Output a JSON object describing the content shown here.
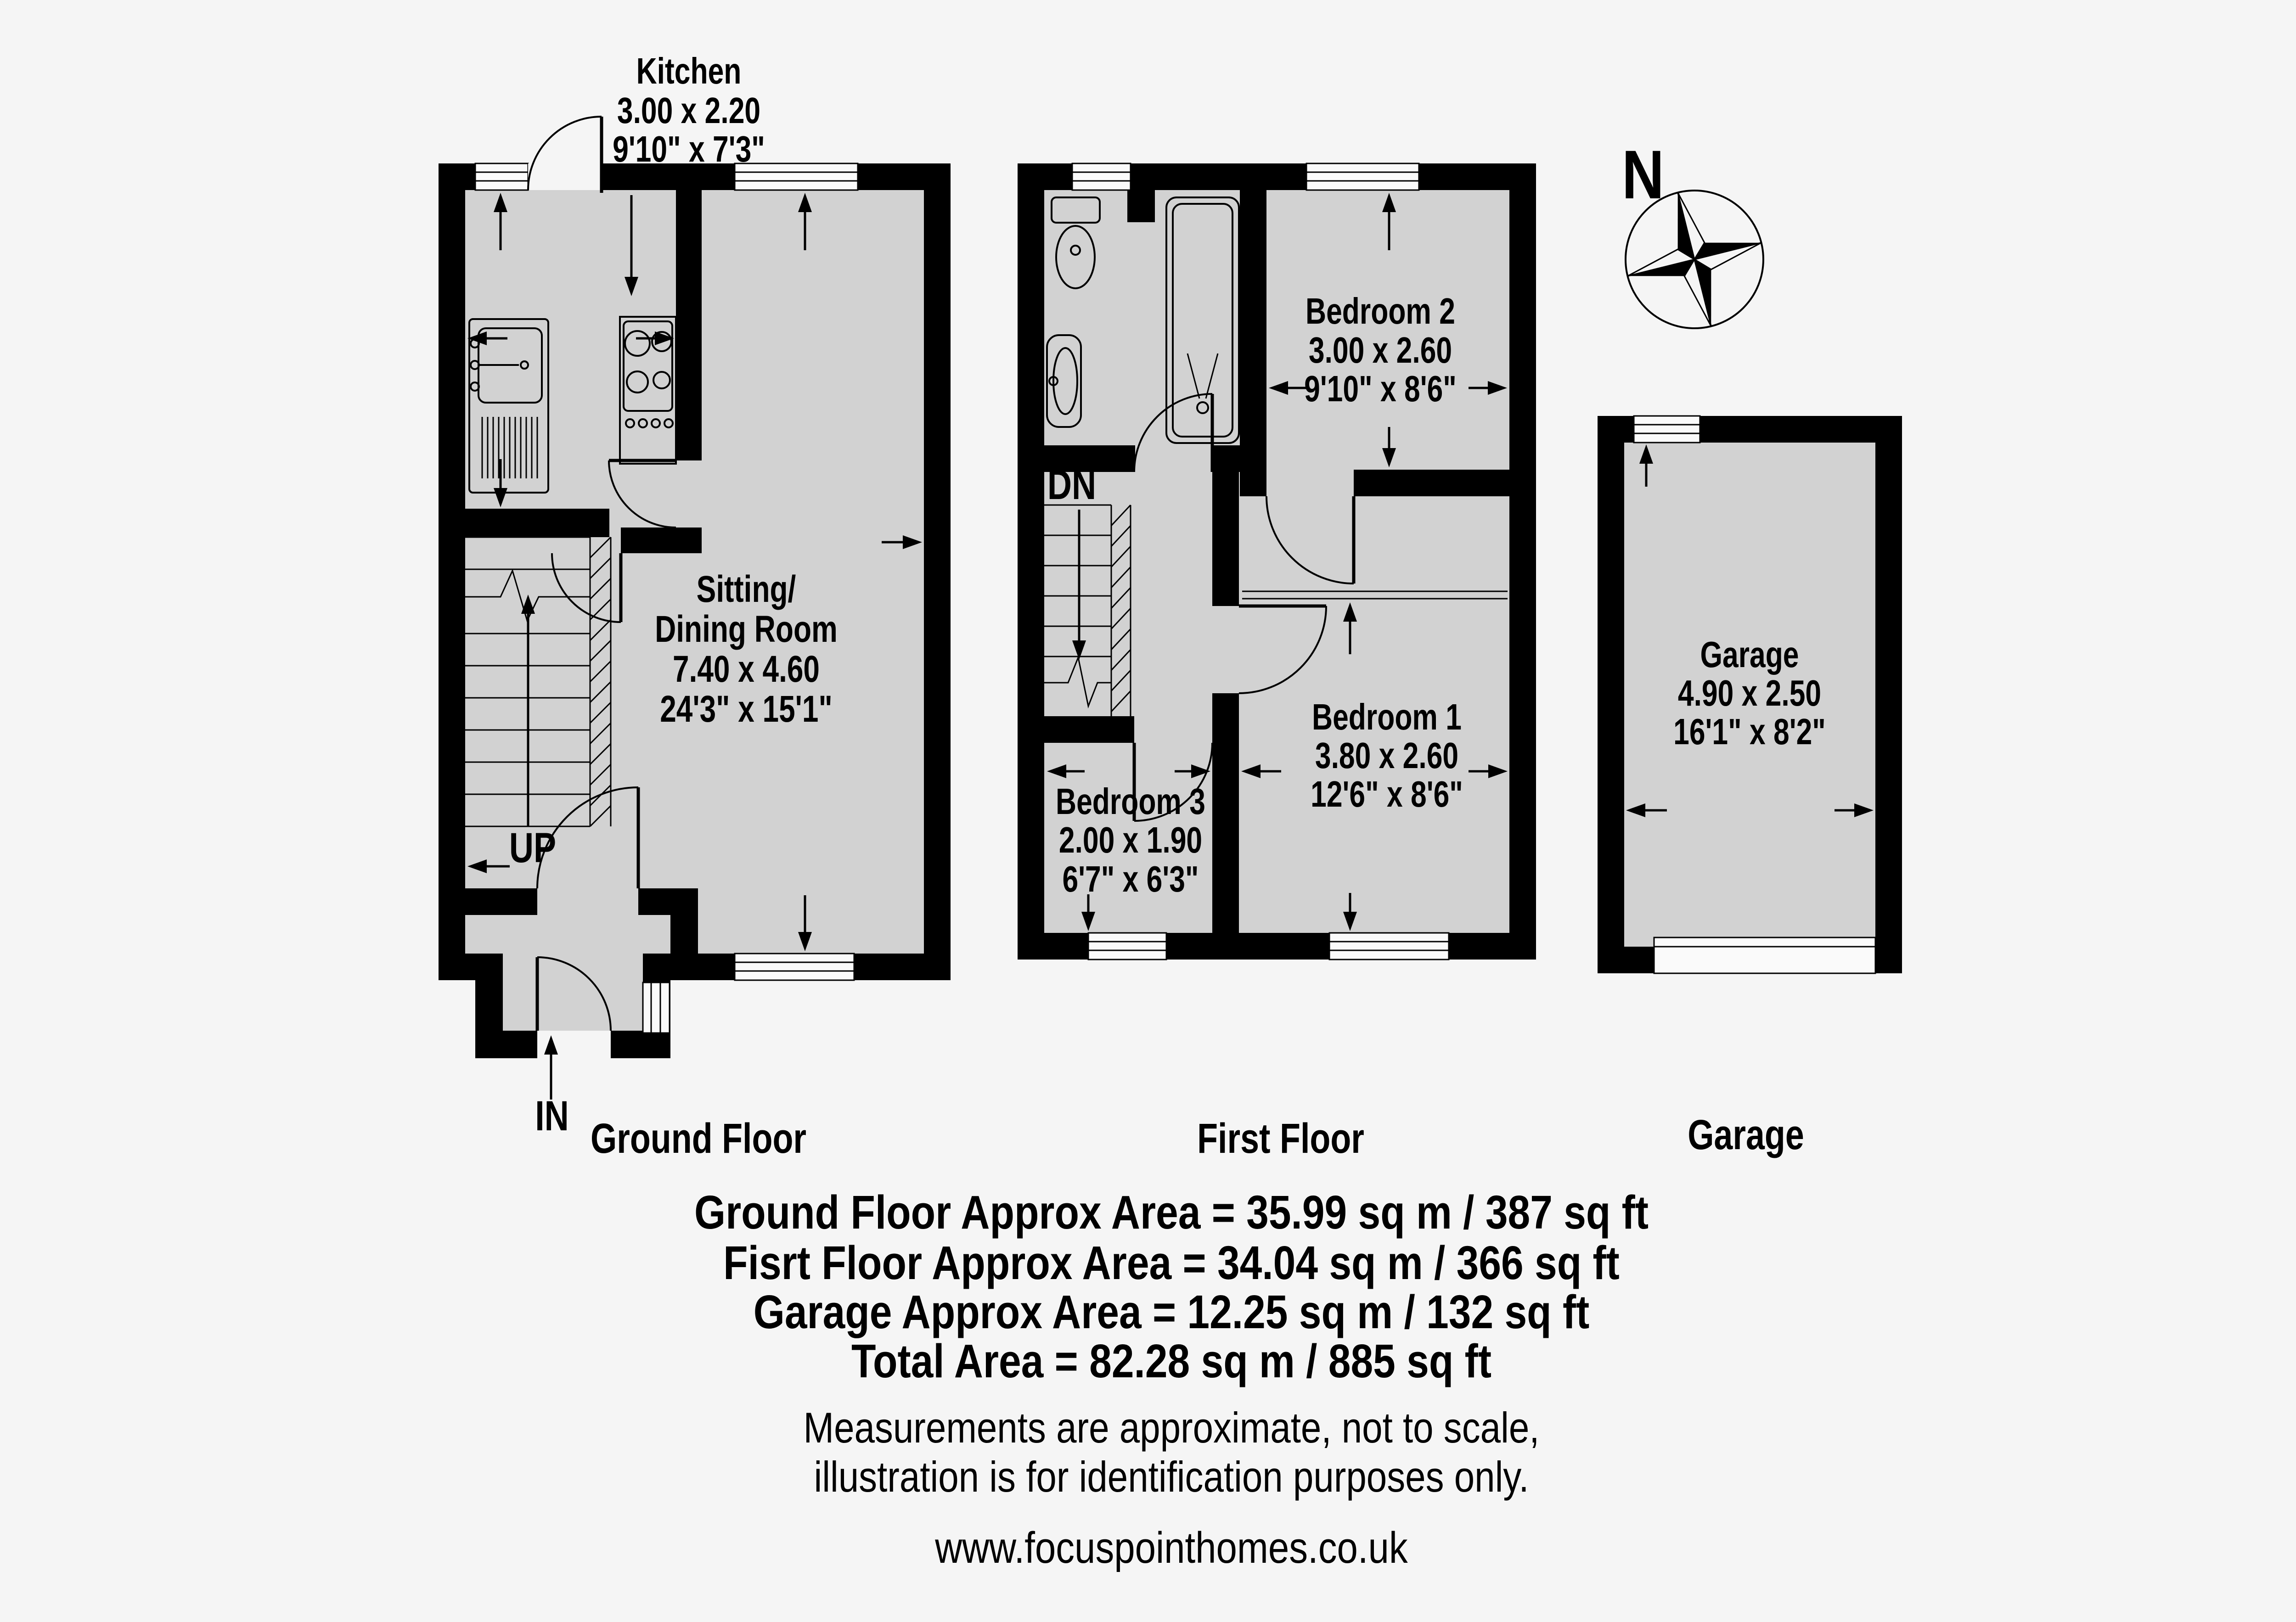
{
  "background_color": "#f5f5f5",
  "colors": {
    "wall": "#000000",
    "room_fill": "#d2d2d2",
    "window_fill": "#fafafa",
    "text": "#000000"
  },
  "ground_floor": {
    "caption": "Ground Floor",
    "kitchen": {
      "name": "Kitchen",
      "size_metric": "3.00 x 2.20",
      "size_imperial": "9'10\" x 7'3\""
    },
    "sitting_dining": {
      "name_line1": "Sitting/",
      "name_line2": "Dining Room",
      "size_metric": "7.40 x 4.60",
      "size_imperial": "24'3\" x 15'1\""
    },
    "stairs_label": "UP",
    "entrance_label": "IN"
  },
  "first_floor": {
    "caption": "First Floor",
    "bedroom1": {
      "name": "Bedroom 1",
      "size_metric": "3.80 x 2.60",
      "size_imperial": "12'6\" x 8'6\""
    },
    "bedroom2": {
      "name": "Bedroom 2",
      "size_metric": "3.00 x 2.60",
      "size_imperial": "9'10\" x 8'6\""
    },
    "bedroom3": {
      "name": "Bedroom 3",
      "size_metric": "2.00 x 1.90",
      "size_imperial": "6'7\" x 6'3\""
    },
    "stairs_label": "DN"
  },
  "garage": {
    "caption": "Garage",
    "name": "Garage",
    "size_metric": "4.90 x 2.50",
    "size_imperial": "16'1\" x 8'2\""
  },
  "compass": {
    "north_label": "N"
  },
  "area_summary": [
    "Ground Floor Approx Area = 35.99 sq m / 387 sq ft",
    "Fisrt Floor Approx Area = 34.04 sq m / 366 sq ft",
    "Garage Approx Area = 12.25 sq m / 132 sq ft",
    "Total Area = 82.28 sq m / 885 sq ft"
  ],
  "disclaimer": [
    "Measurements are approximate, not to scale,",
    "illustration is for identification purposes only."
  ],
  "website": "www.focuspointhomes.co.uk"
}
